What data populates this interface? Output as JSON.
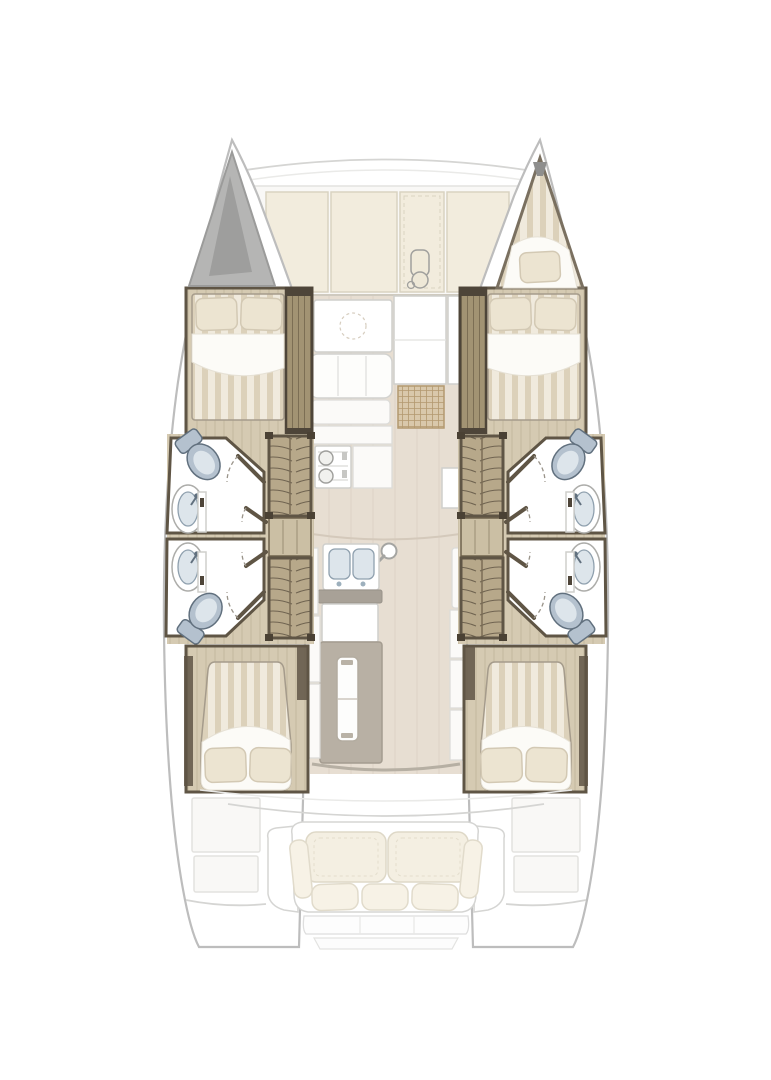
{
  "page": {
    "background": "#ffffff"
  },
  "colors": {
    "hull_outline": "#bdbdbd",
    "faded_line": "#e3e2df",
    "faded_fill": "#f9f8f6",
    "deck_cushion": "#f2ecdd",
    "deck_cushion_line": "#d9d3c1",
    "dark_wood": "#5f5545",
    "mid_wood": "#a29373",
    "grain_line": "#7c6e54",
    "wood_floor": "#d5cab2",
    "floor_grain": "#c3b89e",
    "salon_floor": "#e7ded2",
    "plank_line": "#ddd3c6",
    "stair_wood": "#b7a88a",
    "tread_line": "#6f6350",
    "landing_wood": "#cbbfa4",
    "mattress": "#f0eadd",
    "mattress_stripe": "#dcd1ba",
    "pillow": "#ece4d1",
    "pillow_line": "#d3c9b4",
    "sheet": "#fcfbf7",
    "fixture_bowl": "#b4c1ce",
    "fixture_dark": "#61707e",
    "fixture_inner": "#dde5eb",
    "locker": "#b5b5b4",
    "locker_dark": "#9e9e9d",
    "island_gray": "#b8b0a4",
    "counter_gray": "#a8a197",
    "mat_fill": "#d9c8ab",
    "mat_line": "#b3996f",
    "unit_line": "#cfcfcc",
    "cockpit_line": "#d5d5d3",
    "swing_arc": "#9a948a"
  },
  "plan": {
    "type": "catamaran-floorplan",
    "view": "top-down",
    "hulls": [
      {
        "side": "port",
        "bow_feature": "anchor-locker",
        "rooms": [
          "forward-double-berth-cabin",
          "forward-bathroom",
          "aft-bathroom",
          "companionway-stairs",
          "aft-double-berth-cabin"
        ],
        "bathroom_fixtures": [
          "toilet",
          "sink",
          "sink",
          "toilet"
        ]
      },
      {
        "side": "starboard",
        "bow_feature": "bow-berth-with-pillow",
        "rooms": [
          "forward-double-berth-cabin",
          "forward-bathroom",
          "aft-bathroom",
          "companionway-stairs",
          "aft-double-berth-cabin"
        ],
        "bathroom_fixtures": [
          "toilet",
          "sink",
          "sink",
          "toilet"
        ]
      }
    ],
    "bridgedeck": {
      "foredeck": [
        "sunpad-cushion",
        "sunpad-cushion",
        "windlass-panel",
        "sunpad-cushion"
      ],
      "salon": [
        "dinette-table",
        "settee",
        "galley-counter",
        "stove",
        "storage-cabinet",
        "woven-mat",
        "double-sink",
        "galley-island",
        "storage-strips"
      ],
      "cockpit": [
        "bench-seat",
        "back-cushions",
        "seat-pillows",
        "transom-steps",
        "side-deck-lockers"
      ]
    }
  }
}
